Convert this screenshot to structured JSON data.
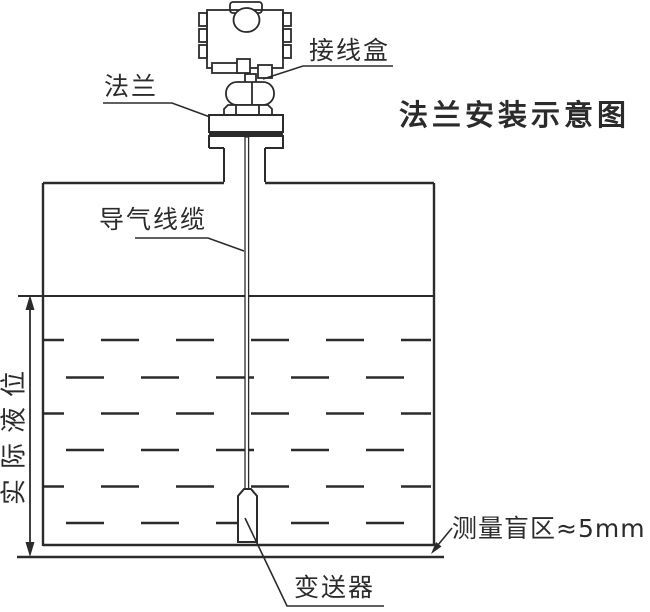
{
  "diagram": {
    "title": "法兰安装示意图",
    "labels": {
      "junction_box": "接线盒",
      "flange": "法兰",
      "air_cable": "导气线缆",
      "actual_level": "实际液位",
      "blind_zone": "测量盲区≈5mm",
      "transmitter": "变送器"
    },
    "colors": {
      "line": "#2b2b2b",
      "background": "#ffffff"
    }
  }
}
